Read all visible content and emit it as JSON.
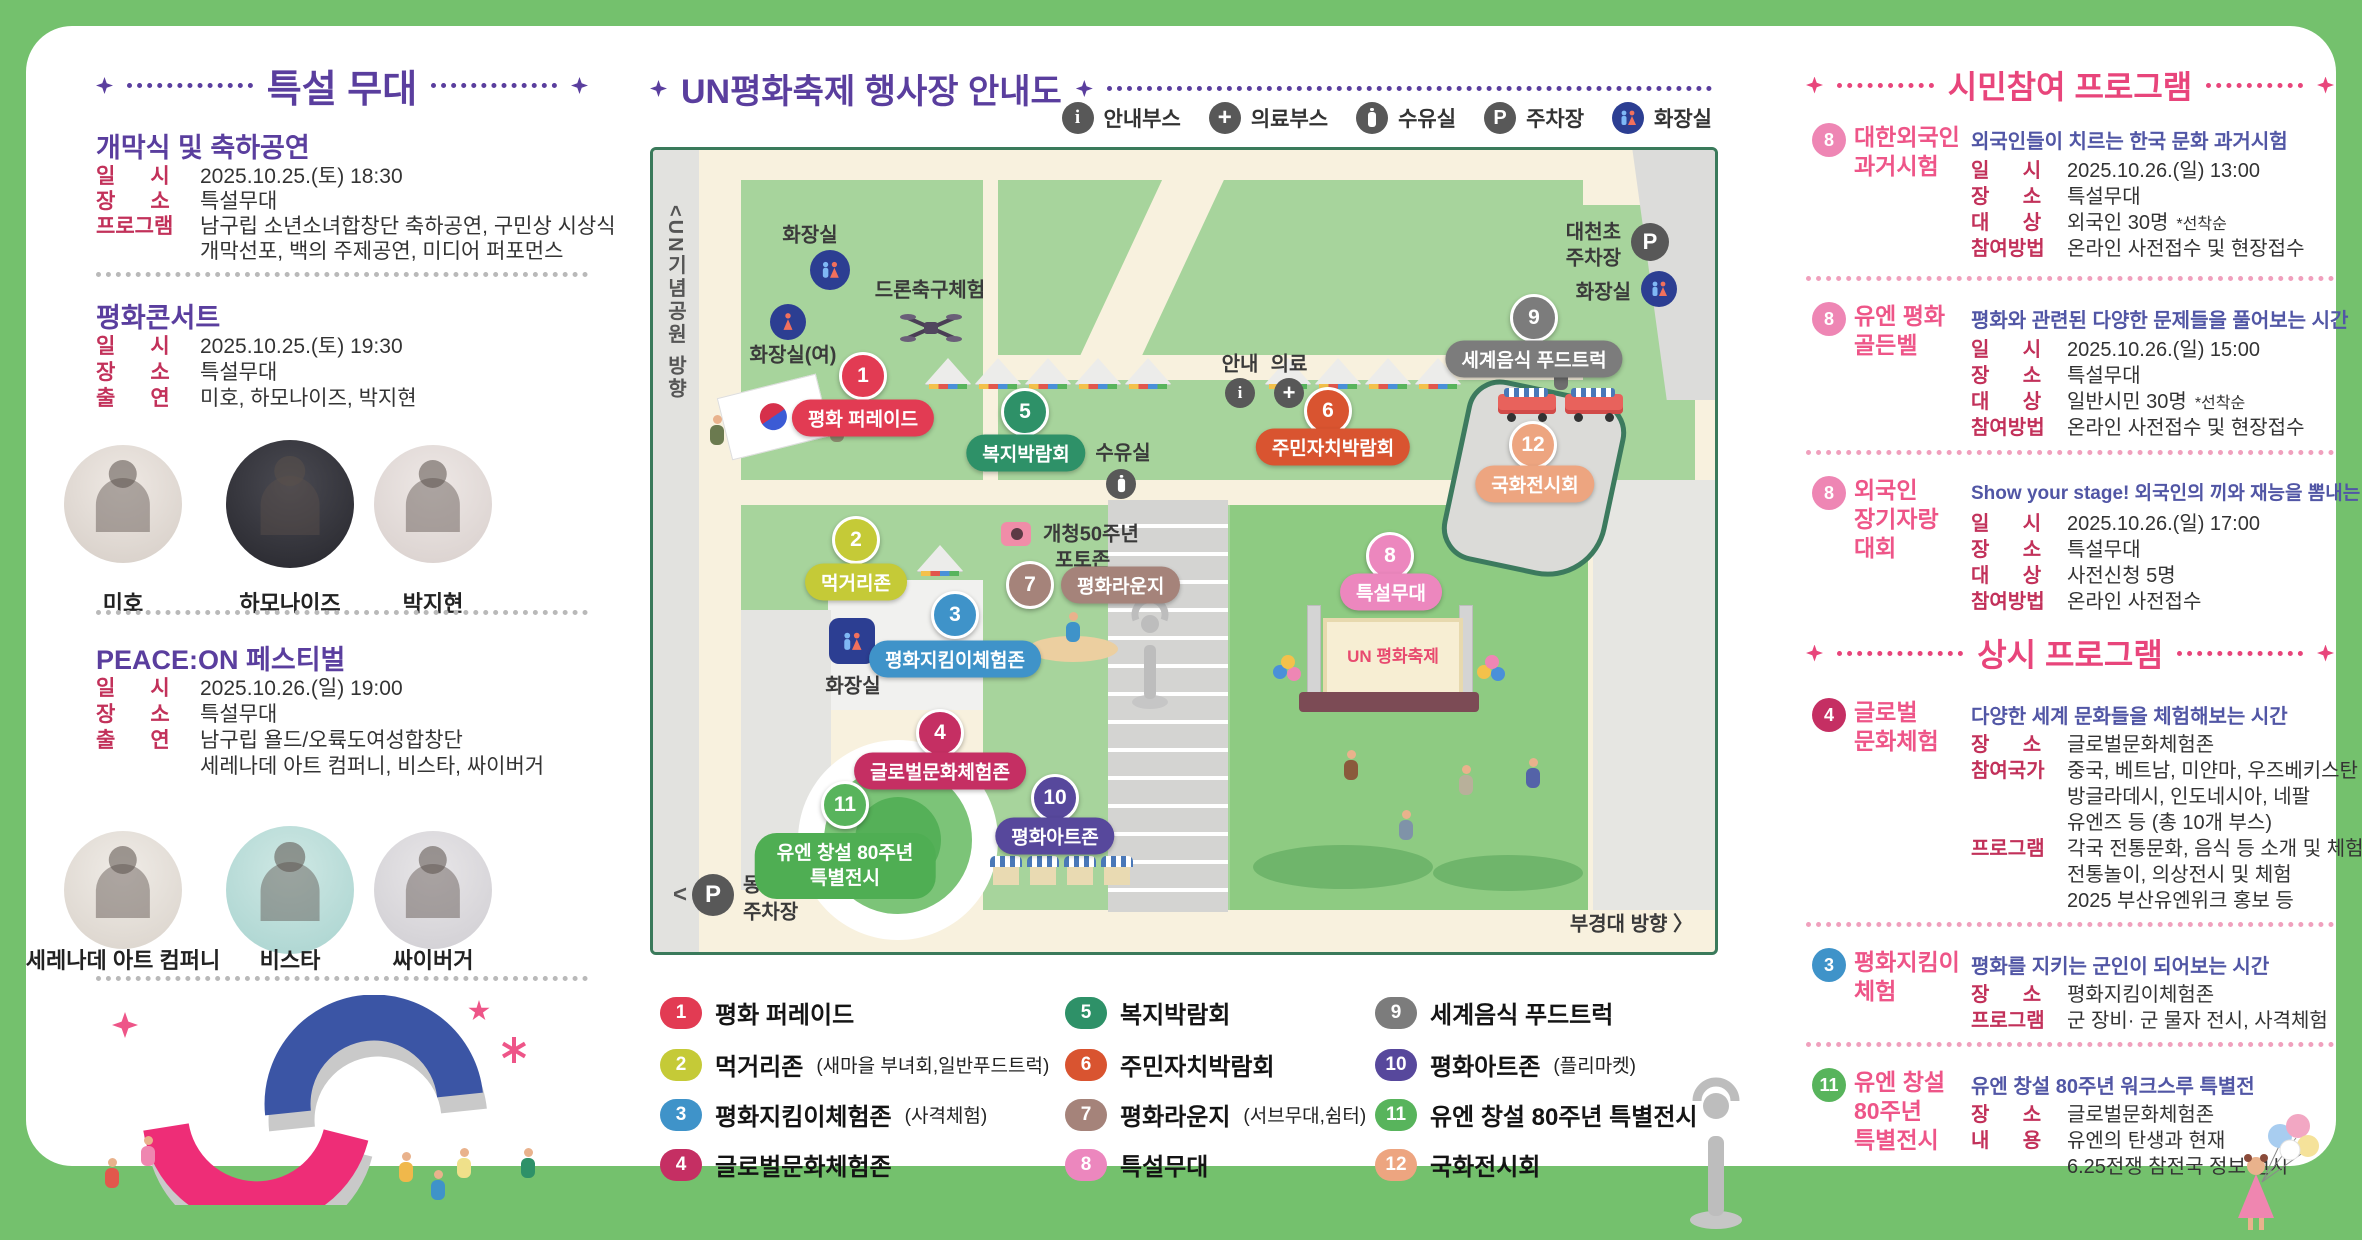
{
  "left": {
    "title": "특설 무대",
    "sections": [
      {
        "heading": "개막식 및 축하공연",
        "rows": [
          {
            "label": "일      시",
            "value": "2025.10.25.(토) 18:30"
          },
          {
            "label": "장      소",
            "value": "특설무대"
          },
          {
            "label": "프로그램",
            "value": "남구립 소년소녀합창단 축하공연, 구민상 시상식"
          },
          {
            "label": "",
            "value": "개막선포, 백의 주제공연, 미디어 퍼포먼스"
          }
        ]
      },
      {
        "heading": "평화콘서트",
        "rows": [
          {
            "label": "일      시",
            "value": "2025.10.25.(토) 19:30"
          },
          {
            "label": "장      소",
            "value": "특설무대"
          },
          {
            "label": "출      연",
            "value": "미호, 하모나이즈, 박지현"
          }
        ],
        "performers": [
          {
            "name": "미호"
          },
          {
            "name": "하모나이즈"
          },
          {
            "name": "박지현"
          }
        ]
      },
      {
        "heading": "PEACE:ON 페스티벌",
        "rows": [
          {
            "label": "일      시",
            "value": "2025.10.26.(일) 19:00"
          },
          {
            "label": "장      소",
            "value": "특설무대"
          },
          {
            "label": "출      연",
            "value": "남구립 욜드/오륙도여성합창단"
          },
          {
            "label": "",
            "value": "세레나데 아트 컴퍼니, 비스타, 싸이버거"
          }
        ],
        "performers": [
          {
            "name": "세레나데 아트 컴퍼니"
          },
          {
            "name": "비스타"
          },
          {
            "name": "싸이버거"
          }
        ]
      }
    ]
  },
  "map": {
    "title": "UN평화축제 행사장 안내도",
    "legend_icons": [
      {
        "label": "안내부스"
      },
      {
        "label": "의료부스"
      },
      {
        "label": "수유실"
      },
      {
        "label": "주차장"
      },
      {
        "label": "화장실"
      }
    ],
    "markers": [
      {
        "num": "1",
        "label": "평화 퍼레이드",
        "color": "#e23b53"
      },
      {
        "num": "2",
        "label": "먹거리존",
        "color": "#c5ca37"
      },
      {
        "num": "3",
        "label": "평화지킴이체험존",
        "color": "#3f93c9"
      },
      {
        "num": "4",
        "label": "글로벌문화체험존",
        "color": "#c52f63"
      },
      {
        "num": "5",
        "label": "복지박람회",
        "color": "#2e9168"
      },
      {
        "num": "6",
        "label": "주민자치박람회",
        "color": "#d95430"
      },
      {
        "num": "7",
        "label": "평화라운지",
        "color": "#a5837a"
      },
      {
        "num": "8",
        "label": "특설무대",
        "color": "#ec87be"
      },
      {
        "num": "9",
        "label": "세계음식 푸드트럭",
        "color": "#7c7c7c"
      },
      {
        "num": "10",
        "label": "평화아트존",
        "color": "#57489c"
      },
      {
        "num": "11",
        "label": "",
        "color": "#58b45c"
      },
      {
        "num": "12",
        "label": "국화전시회",
        "color": "#eda580"
      }
    ],
    "special_exhibit": {
      "line1": "유엔 창설 80주년",
      "line2": "특별전시",
      "color": "#4fae53"
    },
    "labels": {
      "un_direction": "<UN기념공원 방향",
      "toilet_top": "화장실",
      "toilet_women": "화장실(여)",
      "drone": "드론축구체험",
      "nursing": "수유실",
      "info": "안내",
      "medical": "의료",
      "photozone1": "개청50주년",
      "photozone2": "포토존",
      "daecheon1": "대천초",
      "daecheon2": "주차장",
      "toilet_right": "화장실",
      "toilet_mid": "화장실",
      "dongmyeong_chevron": "<",
      "dongmyeong1": "동명대",
      "dongmyeong2": "주차장",
      "bukyeong": "부경대 방향 〉",
      "stage_sign": "UN 평화축제",
      "p": "P",
      "i": "i",
      "plus": "+"
    },
    "legend": [
      {
        "num": "1",
        "color": "#e23b53",
        "label": "평화 퍼레이드",
        "note": ""
      },
      {
        "num": "2",
        "color": "#c5ca37",
        "label": "먹거리존",
        "note": "(새마을 부녀회,일반푸드트럭)"
      },
      {
        "num": "3",
        "color": "#3f93c9",
        "label": "평화지킴이체험존",
        "note": "(사격체험)"
      },
      {
        "num": "4",
        "color": "#c52f63",
        "label": "글로벌문화체험존",
        "note": ""
      },
      {
        "num": "5",
        "color": "#2e9168",
        "label": "복지박람회",
        "note": ""
      },
      {
        "num": "6",
        "color": "#d95430",
        "label": "주민자치박람회",
        "note": ""
      },
      {
        "num": "7",
        "color": "#a5837a",
        "label": "평화라운지",
        "note": "(서브무대,쉼터)"
      },
      {
        "num": "8",
        "color": "#ec87be",
        "label": "특설무대",
        "note": ""
      },
      {
        "num": "9",
        "color": "#7c7c7c",
        "label": "세계음식 푸드트럭",
        "note": ""
      },
      {
        "num": "10",
        "color": "#57489c",
        "label": "평화아트존",
        "note": "(플리마켓)"
      },
      {
        "num": "11",
        "color": "#58b45c",
        "label": "유엔 창설 80주년 특별전시",
        "note": ""
      },
      {
        "num": "12",
        "color": "#eda580",
        "label": "국화전시회",
        "note": ""
      }
    ]
  },
  "right": {
    "header1": "시민참여 프로그램",
    "header2": "상시 프로그램",
    "programs": [
      {
        "badge": "8",
        "badge_color": "#ee86b4",
        "title1": "대한외국인",
        "title2": "과거시험",
        "title3": "",
        "desc": "외국인들이 치르는 한국 문화 과거시험",
        "rows": [
          {
            "label": "일      시",
            "value": "2025.10.26.(일) 13:00"
          },
          {
            "label": "장      소",
            "value": "특설무대"
          },
          {
            "label": "대      상",
            "value": "외국인 30명",
            "note": "*선착순"
          },
          {
            "label": "참여방법",
            "value": "온라인 사전접수 및 현장접수"
          }
        ]
      },
      {
        "badge": "8",
        "badge_color": "#ee86b4",
        "title1": "유엔 평화",
        "title2": "골든벨",
        "title3": "",
        "desc": "평화와 관련된 다양한 문제들을 풀어보는 시간",
        "rows": [
          {
            "label": "일      시",
            "value": "2025.10.26.(일) 15:00"
          },
          {
            "label": "장      소",
            "value": "특설무대"
          },
          {
            "label": "대      상",
            "value": "일반시민 30명",
            "note": "*선착순"
          },
          {
            "label": "참여방법",
            "value": "온라인 사전접수 및 현장접수"
          }
        ]
      },
      {
        "badge": "8",
        "badge_color": "#ee86b4",
        "title1": "외국인",
        "title2": "장기자랑",
        "title3": "대회",
        "desc": "Show your stage! 외국인의 끼와 재능을 뽐내는 시간",
        "rows": [
          {
            "label": "일      시",
            "value": "2025.10.26.(일) 17:00"
          },
          {
            "label": "장      소",
            "value": "특설무대"
          },
          {
            "label": "대      상",
            "value": "사전신청 5명"
          },
          {
            "label": "참여방법",
            "value": "온라인 사전접수"
          }
        ]
      },
      {
        "badge": "4",
        "badge_color": "#c52f63",
        "title1": "글로벌",
        "title2": "문화체험",
        "title3": "",
        "desc": "다양한 세계 문화들을 체험해보는 시간",
        "rows": [
          {
            "label": "장      소",
            "value": "글로벌문화체험존"
          },
          {
            "label": "참여국가",
            "value": "중국, 베트남, 미얀마, 우즈베키스탄"
          },
          {
            "label": "",
            "value": "방글라데시, 인도네시아, 네팔"
          },
          {
            "label": "",
            "value": "유엔즈 등 (총 10개 부스)"
          },
          {
            "label": "프로그램",
            "value": "각국 전통문화, 음식 등 소개 및 체험"
          },
          {
            "label": "",
            "value": "전통놀이, 의상전시 및 체험"
          },
          {
            "label": "",
            "value": "2025 부산유엔위크 홍보 등"
          }
        ]
      },
      {
        "badge": "3",
        "badge_color": "#3f93c9",
        "title1": "평화지킴이",
        "title2": "체험",
        "title3": "",
        "desc": "평화를 지키는 군인이 되어보는 시간",
        "rows": [
          {
            "label": "장      소",
            "value": "평화지킴이체험존"
          },
          {
            "label": "프로그램",
            "value": "군 장비· 군 물자 전시, 사격체험"
          }
        ]
      },
      {
        "badge": "11",
        "badge_color": "#58b45c",
        "title1": "유엔 창설",
        "title2": "80주년",
        "title3": "특별전시",
        "desc": "유엔 창설 80주년 워크스루 특별전",
        "rows": [
          {
            "label": "장      소",
            "value": "글로벌문화체험존"
          },
          {
            "label": "내      용",
            "value": "유엔의 탄생과 현재"
          },
          {
            "label": "",
            "value": "6.25전쟁 참전국 정보 전시"
          }
        ]
      }
    ]
  }
}
